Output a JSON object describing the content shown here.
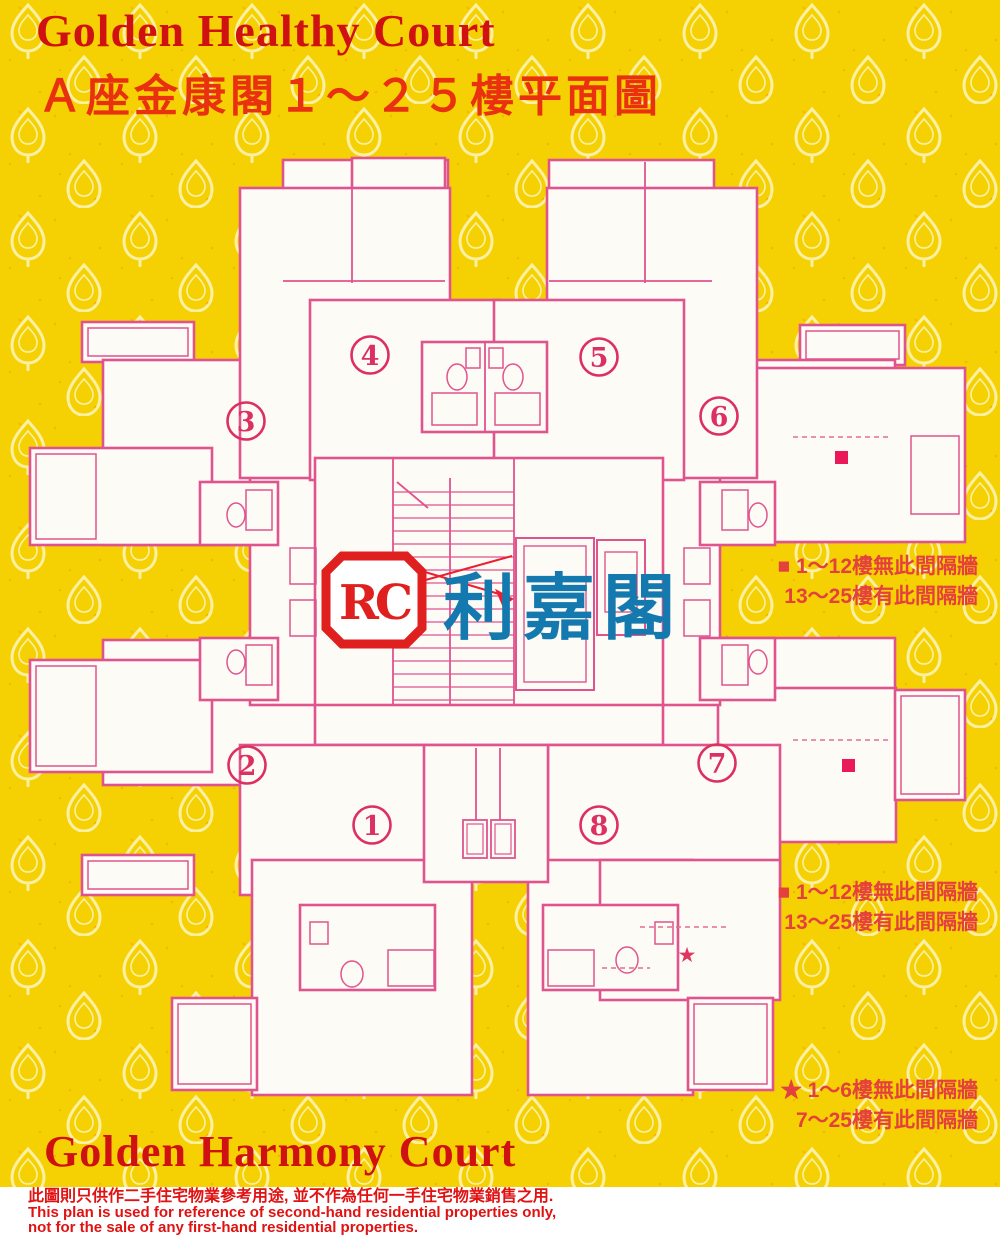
{
  "header": {
    "title_en": "Golden Healthy Court",
    "title_zh": "Ａ座金康閣１～２５樓平面圖"
  },
  "footer": {
    "title_en": "Golden Harmony Court"
  },
  "watermark": {
    "logo_text": "RC",
    "brand_zh": "利嘉閣"
  },
  "plan": {
    "units": [
      "1",
      "2",
      "3",
      "4",
      "5",
      "6",
      "7",
      "8"
    ],
    "star_marker": "★"
  },
  "legend": {
    "note1": {
      "line1": "■ 1～12樓無此間隔牆",
      "line2": "13～25樓有此間隔牆"
    },
    "note2": {
      "line1": "■ 1～12樓無此間隔牆",
      "line2": "13～25樓有此間隔牆"
    },
    "note3": {
      "line1": "★ 1～6樓無此間隔牆",
      "line2": "7～25樓有此間隔牆"
    }
  },
  "disclaimer": {
    "line_zh": "此圖則只供作二手住宅物業參考用途, 並不作為任何一手住宅物業銷售之用.",
    "line_en1": "This plan is used for reference of second-hand residential properties only,",
    "line_en2": "not for the sale of any first-hand residential properties."
  },
  "colors": {
    "background_yellow": "#f5d104",
    "pattern_cream": "#fdf2ad",
    "plan_pink": "#e0548e",
    "unit_crimson": "#dc2f62",
    "marker_magenta": "#ea1a5a",
    "title_red": "#d01112",
    "subtitle_red": "#e93110",
    "legend_red": "#e4403e",
    "watermark_blue": "#1379ae",
    "logo_red": "#e01f1f",
    "disclaimer_red": "#e01212"
  }
}
